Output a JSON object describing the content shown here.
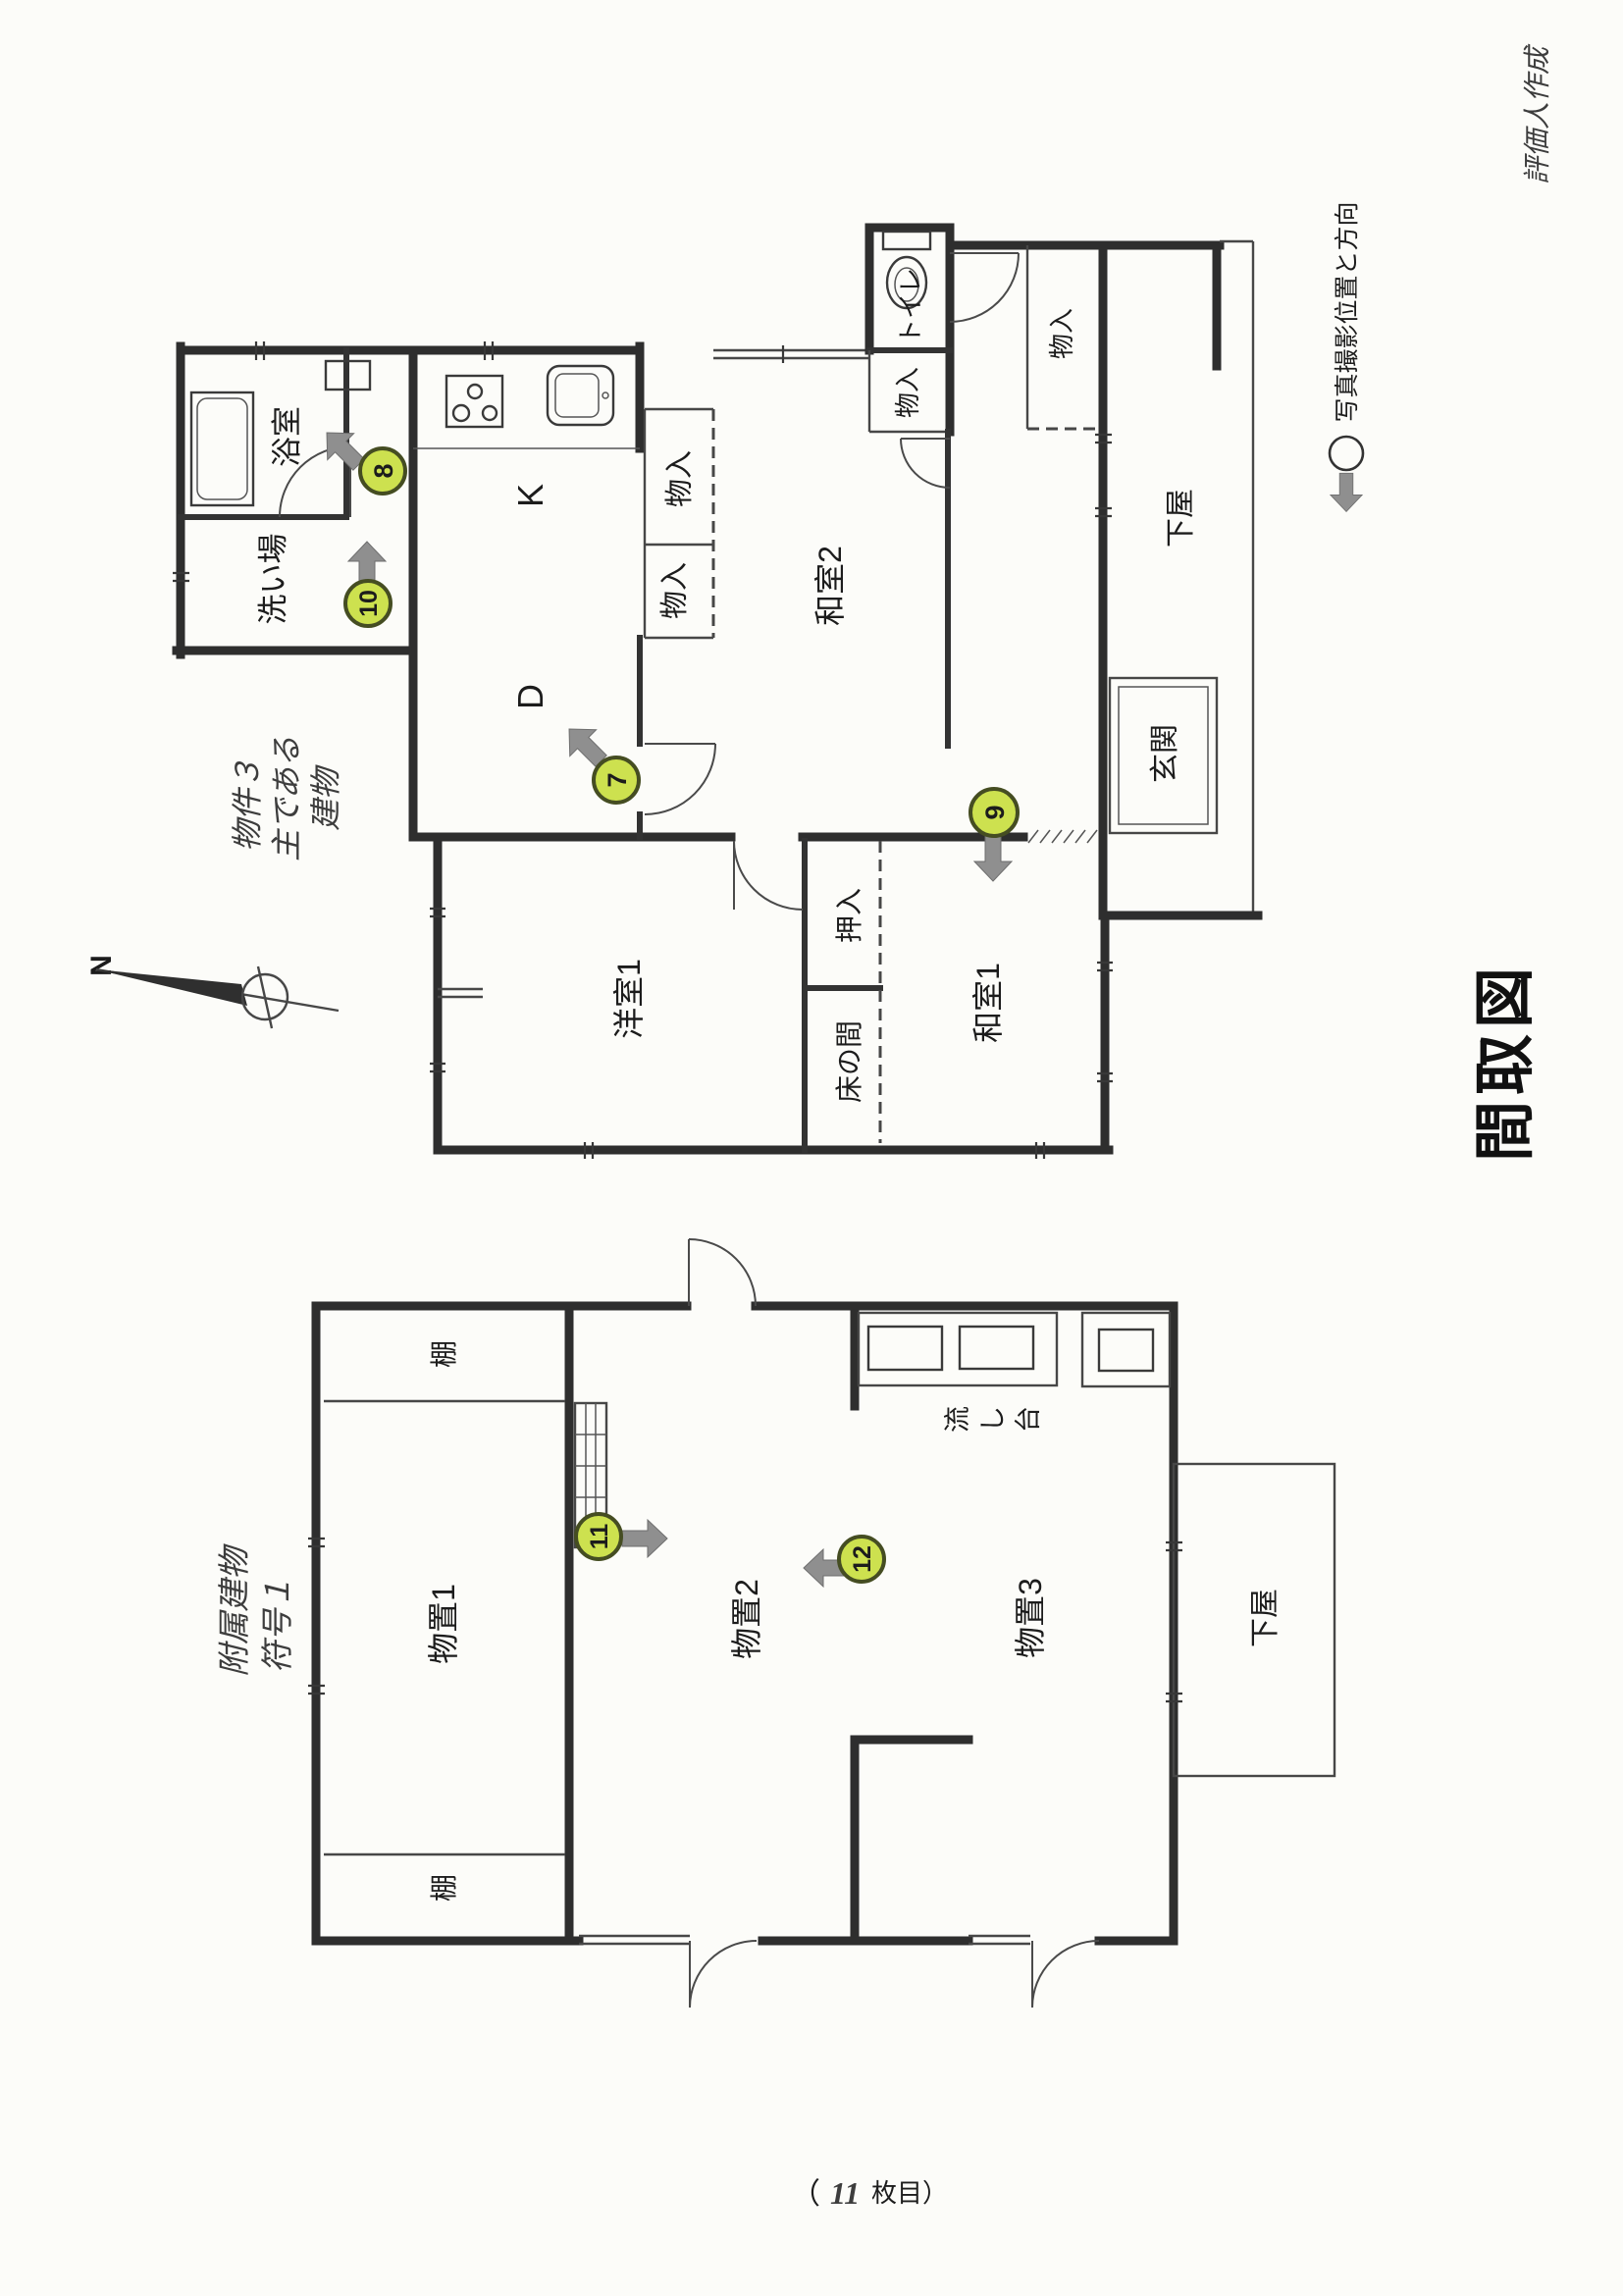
{
  "page": {
    "title": "間取図",
    "note_top_right": "評価人作成",
    "footer_open": "（",
    "footer_number": "11",
    "footer_close": "枚目）"
  },
  "legend": {
    "label": "写真撮影位置と方向"
  },
  "compass": {
    "north": "N"
  },
  "main_building": {
    "note_lines": [
      "物件３",
      "主である",
      "建物"
    ],
    "labels": {
      "bath": "浴室",
      "wash": "洗い場",
      "kitchen": "K",
      "dining": "D",
      "closet_a": "物入",
      "closet_b": "物入",
      "washitsu2": "和室2",
      "toilet": "トイレ",
      "closet_c": "物入",
      "closet_d": "物入",
      "geya": "下屋",
      "genkan": "玄関",
      "yoshitsu1": "洋室1",
      "oshiire": "押入",
      "tokonoma": "床の間",
      "washitsu1": "和室1"
    },
    "markers": [
      {
        "no": "7"
      },
      {
        "no": "8"
      },
      {
        "no": "9"
      },
      {
        "no": "10"
      }
    ]
  },
  "attached_building": {
    "note_lines": [
      "附属建物",
      "符号１"
    ],
    "labels": {
      "shelf_top": "棚",
      "shelf_bottom": "棚",
      "storage1": "物置1",
      "storage2": "物置2",
      "storage3": "物置3",
      "sink": "流し台",
      "geya": "下屋"
    },
    "markers": [
      {
        "no": "11"
      },
      {
        "no": "12"
      }
    ]
  },
  "colors": {
    "wall": "#2e2e2e",
    "marker_fill": "#cde14f",
    "marker_stroke": "#454d22",
    "arrow_gray": "#8f8f8f",
    "paper": "#fcfcf9"
  }
}
